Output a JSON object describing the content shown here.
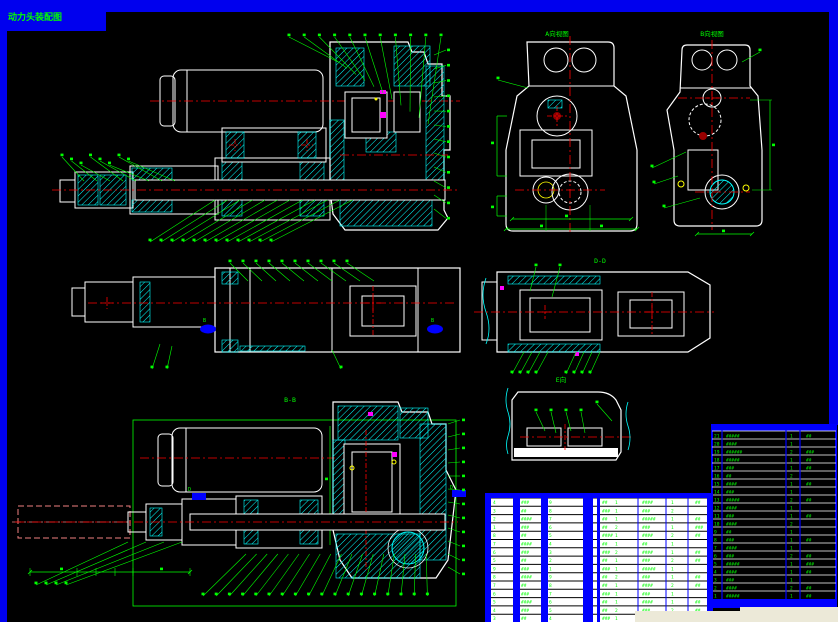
{
  "window": {
    "tab_title": "动力头装配图"
  },
  "view_labels": {
    "front": "A向视图",
    "rear": "B向视图",
    "mid_section": "D-D",
    "detail": "E向",
    "bottom_section": "B-B"
  },
  "section_markers": {
    "plan_left": "B",
    "plan_right": "B",
    "bottom_left": "D",
    "bottom_right": "D"
  },
  "colors": {
    "frame": "#0000ee",
    "canvas": "#000000",
    "outline": "#ffffff",
    "hatch": "#00ffff",
    "annotation": "#00ff00",
    "centerline": "#ff0000",
    "accent": "#ff00ff",
    "highlight": "#ffff00",
    "marker": "#0000ff",
    "ghost": "#f08080",
    "table_rule": "#0000ff",
    "status_strip": "#ece9d8"
  },
  "parts_table": {
    "rows": [
      [
        "21",
        "#####",
        "1",
        "##"
      ],
      [
        "20",
        "####",
        "1",
        ""
      ],
      [
        "19",
        "######",
        "2",
        "###"
      ],
      [
        "18",
        "#####",
        "1",
        "##"
      ],
      [
        "17",
        "###",
        "1",
        "##"
      ],
      [
        "16",
        "##",
        "2",
        ""
      ],
      [
        "15",
        "####",
        "1",
        "##"
      ],
      [
        "14",
        "###",
        "1",
        ""
      ],
      [
        "13",
        "#####",
        "2",
        "##"
      ],
      [
        "12",
        "####",
        "1",
        ""
      ],
      [
        "11",
        "###",
        "1",
        "##"
      ],
      [
        "10",
        "####",
        "2",
        ""
      ],
      [
        "9",
        "##",
        "1",
        ""
      ],
      [
        "8",
        "###",
        "1",
        "##"
      ],
      [
        "7",
        "####",
        "1",
        ""
      ],
      [
        "6",
        "###",
        "2",
        "##"
      ],
      [
        "5",
        "#####",
        "1",
        "###"
      ],
      [
        "4",
        "####",
        "1",
        "##"
      ],
      [
        "3",
        "###",
        "1",
        ""
      ],
      [
        "2",
        "####",
        "2",
        "##"
      ],
      [
        "1",
        "#####",
        "1",
        "##"
      ]
    ]
  },
  "bom_extension": {
    "rows": [
      [
        "4",
        "###",
        "9",
        "##",
        "1",
        "####",
        "1",
        "##"
      ],
      [
        "3",
        "##",
        "8",
        "###",
        "1",
        "###",
        "2",
        ""
      ],
      [
        "2",
        "####",
        "7",
        "##",
        "1",
        "#####",
        "1",
        "##"
      ],
      [
        "1",
        "###",
        "6",
        "##",
        "2",
        "###",
        "1",
        "###"
      ],
      [
        "8",
        "##",
        "5",
        "####",
        "1",
        "####",
        "2",
        "##"
      ],
      [
        "7",
        "####",
        "4",
        "##",
        "1",
        "##",
        "1",
        ""
      ],
      [
        "6",
        "###",
        "3",
        "###",
        "2",
        "####",
        "1",
        "##"
      ],
      [
        "5",
        "##",
        "2",
        "##",
        "1",
        "###",
        "2",
        "##"
      ],
      [
        "9",
        "###",
        "1",
        "###",
        "1",
        "#####",
        "1",
        ""
      ],
      [
        "8",
        "####",
        "9",
        "##",
        "2",
        "###",
        "1",
        "##"
      ],
      [
        "7",
        "##",
        "8",
        "##",
        "1",
        "####",
        "2",
        "##"
      ],
      [
        "6",
        "###",
        "7",
        "###",
        "1",
        "###",
        "1",
        ""
      ],
      [
        "5",
        "####",
        "6",
        "##",
        "1",
        "####",
        "1",
        "##"
      ],
      [
        "4",
        "###",
        "5",
        "##",
        "2",
        "###",
        "2",
        "##"
      ],
      [
        "3",
        "##",
        "4",
        "###",
        "1",
        "####",
        "1",
        "##"
      ]
    ]
  }
}
